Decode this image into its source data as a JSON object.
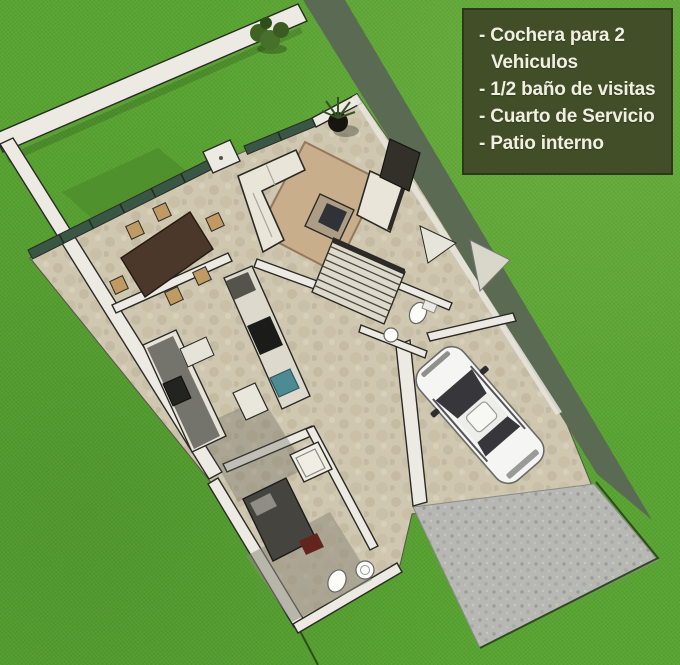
{
  "scene": {
    "description": "Top-down 3D rendered floor plan of a house lot on a green lawn",
    "rooms": [
      "patio interno",
      "comedor",
      "sala",
      "cocina",
      "escalera",
      "medio bano de visitas",
      "cuarto de servicio",
      "bano de servicio",
      "cochera",
      "entrada vehicular"
    ]
  },
  "info_box": {
    "items": [
      "- Cochera para 2 Vehiculos",
      "- 1/2 baño de visitas",
      "- Cuarto de Servicio",
      "- Patio interno"
    ]
  },
  "colors": {
    "lawn": "#58a331",
    "lawn_patch": "#4f8f2c",
    "wall_shadow": "#5b6a52",
    "wall_white": "#eceae2",
    "outline": "#2a2a26",
    "floor": "#cfc7b0",
    "floor_spot": "#b9ae92",
    "glass": "#3a5644",
    "furniture_dark": "#4c382a",
    "chair": "#c09a62",
    "sofa": "#e9e5d8",
    "rug": "#c9ae8b",
    "driveway": "#b7b8b4",
    "car": "#f5f5f3",
    "car_glass": "#37373b",
    "sink_teal": "#4d8b94",
    "bed": "#45443f",
    "accent_red": "#62241c",
    "box_bg": "#414e28",
    "box_text": "#f1efe2",
    "boundary_line": "#2e4c1c"
  }
}
